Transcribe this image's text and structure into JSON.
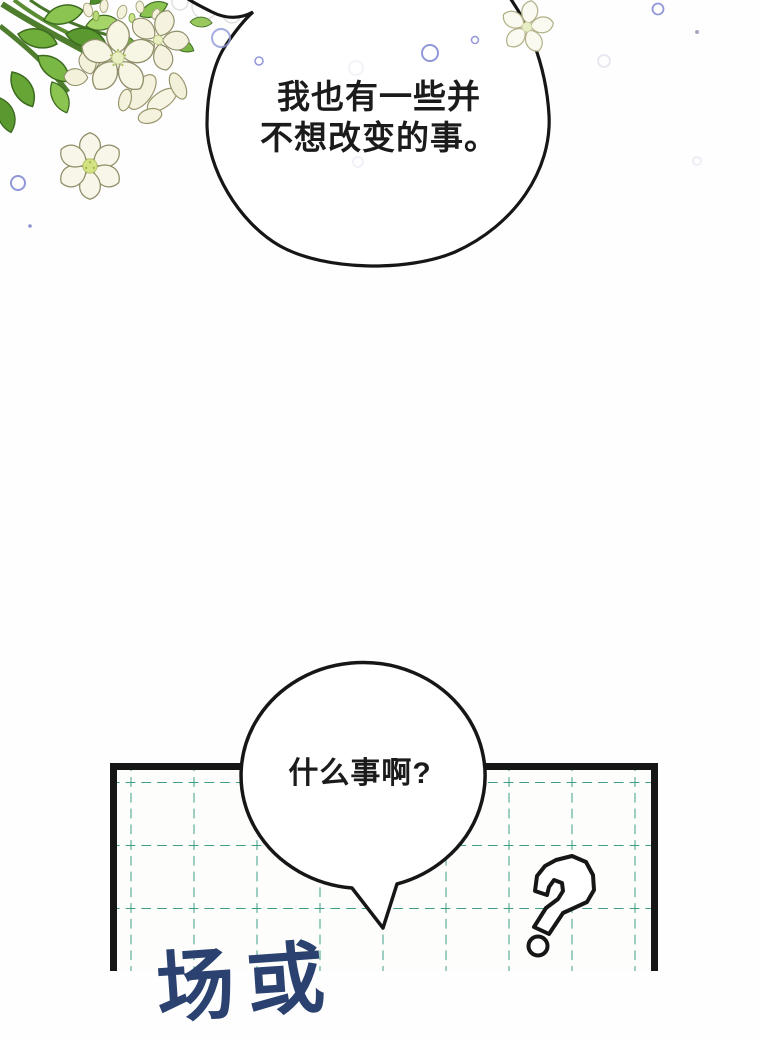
{
  "page": {
    "bg_color": "#fefefe",
    "ink_color": "#161616"
  },
  "dialogue": {
    "top": {
      "line1": "我也有一些并",
      "line2": "不想改变的事。"
    },
    "bottom": {
      "line1": "什么事啊?"
    }
  },
  "caption": {
    "partial_text": "场或",
    "color": "#2b4170"
  },
  "panel": {
    "grid_color": "#3f9e86",
    "border_color": "#161616",
    "bg_color": "#fdfdfb"
  },
  "bubbles": {
    "fill": "#ffffff",
    "stroke": "#161616"
  },
  "decor": {
    "floating_bubble_color": "#9197d8",
    "faint_bubble_color": "#eceef5",
    "flower_petal_color": "#f7f5e3",
    "flower_center_color": "#e9efc0",
    "leaf_color": "#6fae3a",
    "icons": {
      "question_mark_doodle": "hand-drawn outlined question mark",
      "flower_bouquet": "white flower bouquet with green leaves",
      "single_flower": "single white blossom",
      "edge_flower": "small blossom on bubble rim"
    }
  }
}
